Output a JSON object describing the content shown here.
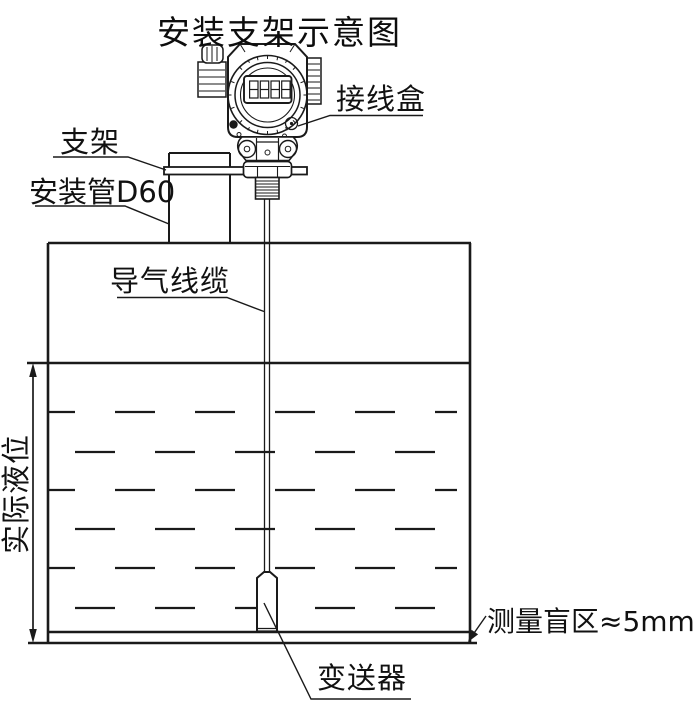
{
  "title": "安装支架示意图",
  "labels": {
    "junction_box": "接线盒",
    "bracket": "支架",
    "mounting_pipe": "安装管D60",
    "air_cable": "导气线缆",
    "actual_level": "实际液位",
    "blind_zone": "测量盲区≈5mm",
    "transmitter": "变送器"
  },
  "diagram": {
    "kind": "level-transmitter-installation-schematic",
    "line_color": "#1a1a1a",
    "background_color": "#ffffff",
    "display_digits": "8888",
    "blind_zone_value": "≈5mm",
    "pipe_spec": "D60"
  }
}
